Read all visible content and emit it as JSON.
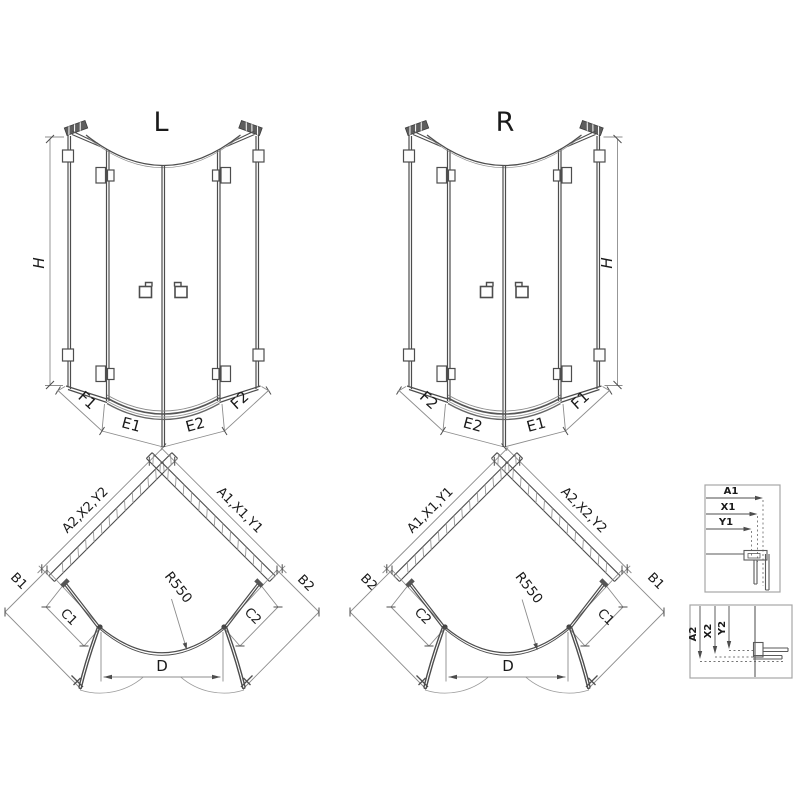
{
  "elevation_left": {
    "title": "L",
    "height_label": "H",
    "dim_labels": {
      "f1": "F1",
      "e1": "E1",
      "e2": "E2",
      "f2": "F2"
    }
  },
  "elevation_right": {
    "title": "R",
    "height_label": "H",
    "dim_labels": {
      "f2": "F2",
      "e2": "E2",
      "e1": "E1",
      "f1": "F1"
    }
  },
  "plan_left": {
    "wall_left": "A2,X2,Y2",
    "wall_right": "A1,X1,Y1",
    "outer_left": "B1",
    "outer_right": "B2",
    "panel_left": "C1",
    "panel_right": "C2",
    "radius": "R550",
    "entry": "D"
  },
  "plan_right": {
    "wall_left": "A1,X1,Y1",
    "wall_right": "A2,X2,Y2",
    "outer_left": "B2",
    "outer_right": "B1",
    "panel_left": "C2",
    "panel_right": "C1",
    "radius": "R550",
    "entry": "D"
  },
  "detail_top": {
    "dims": [
      "A1",
      "X1",
      "Y1"
    ]
  },
  "detail_bottom": {
    "dims": [
      "A2",
      "X2",
      "Y2"
    ]
  },
  "colors": {
    "line": "#4d4d4d",
    "dim": "#8c8c8c",
    "hatch": "#9a9a9a",
    "text": "#1a1a1a",
    "box_border": "#a6a6a6"
  }
}
